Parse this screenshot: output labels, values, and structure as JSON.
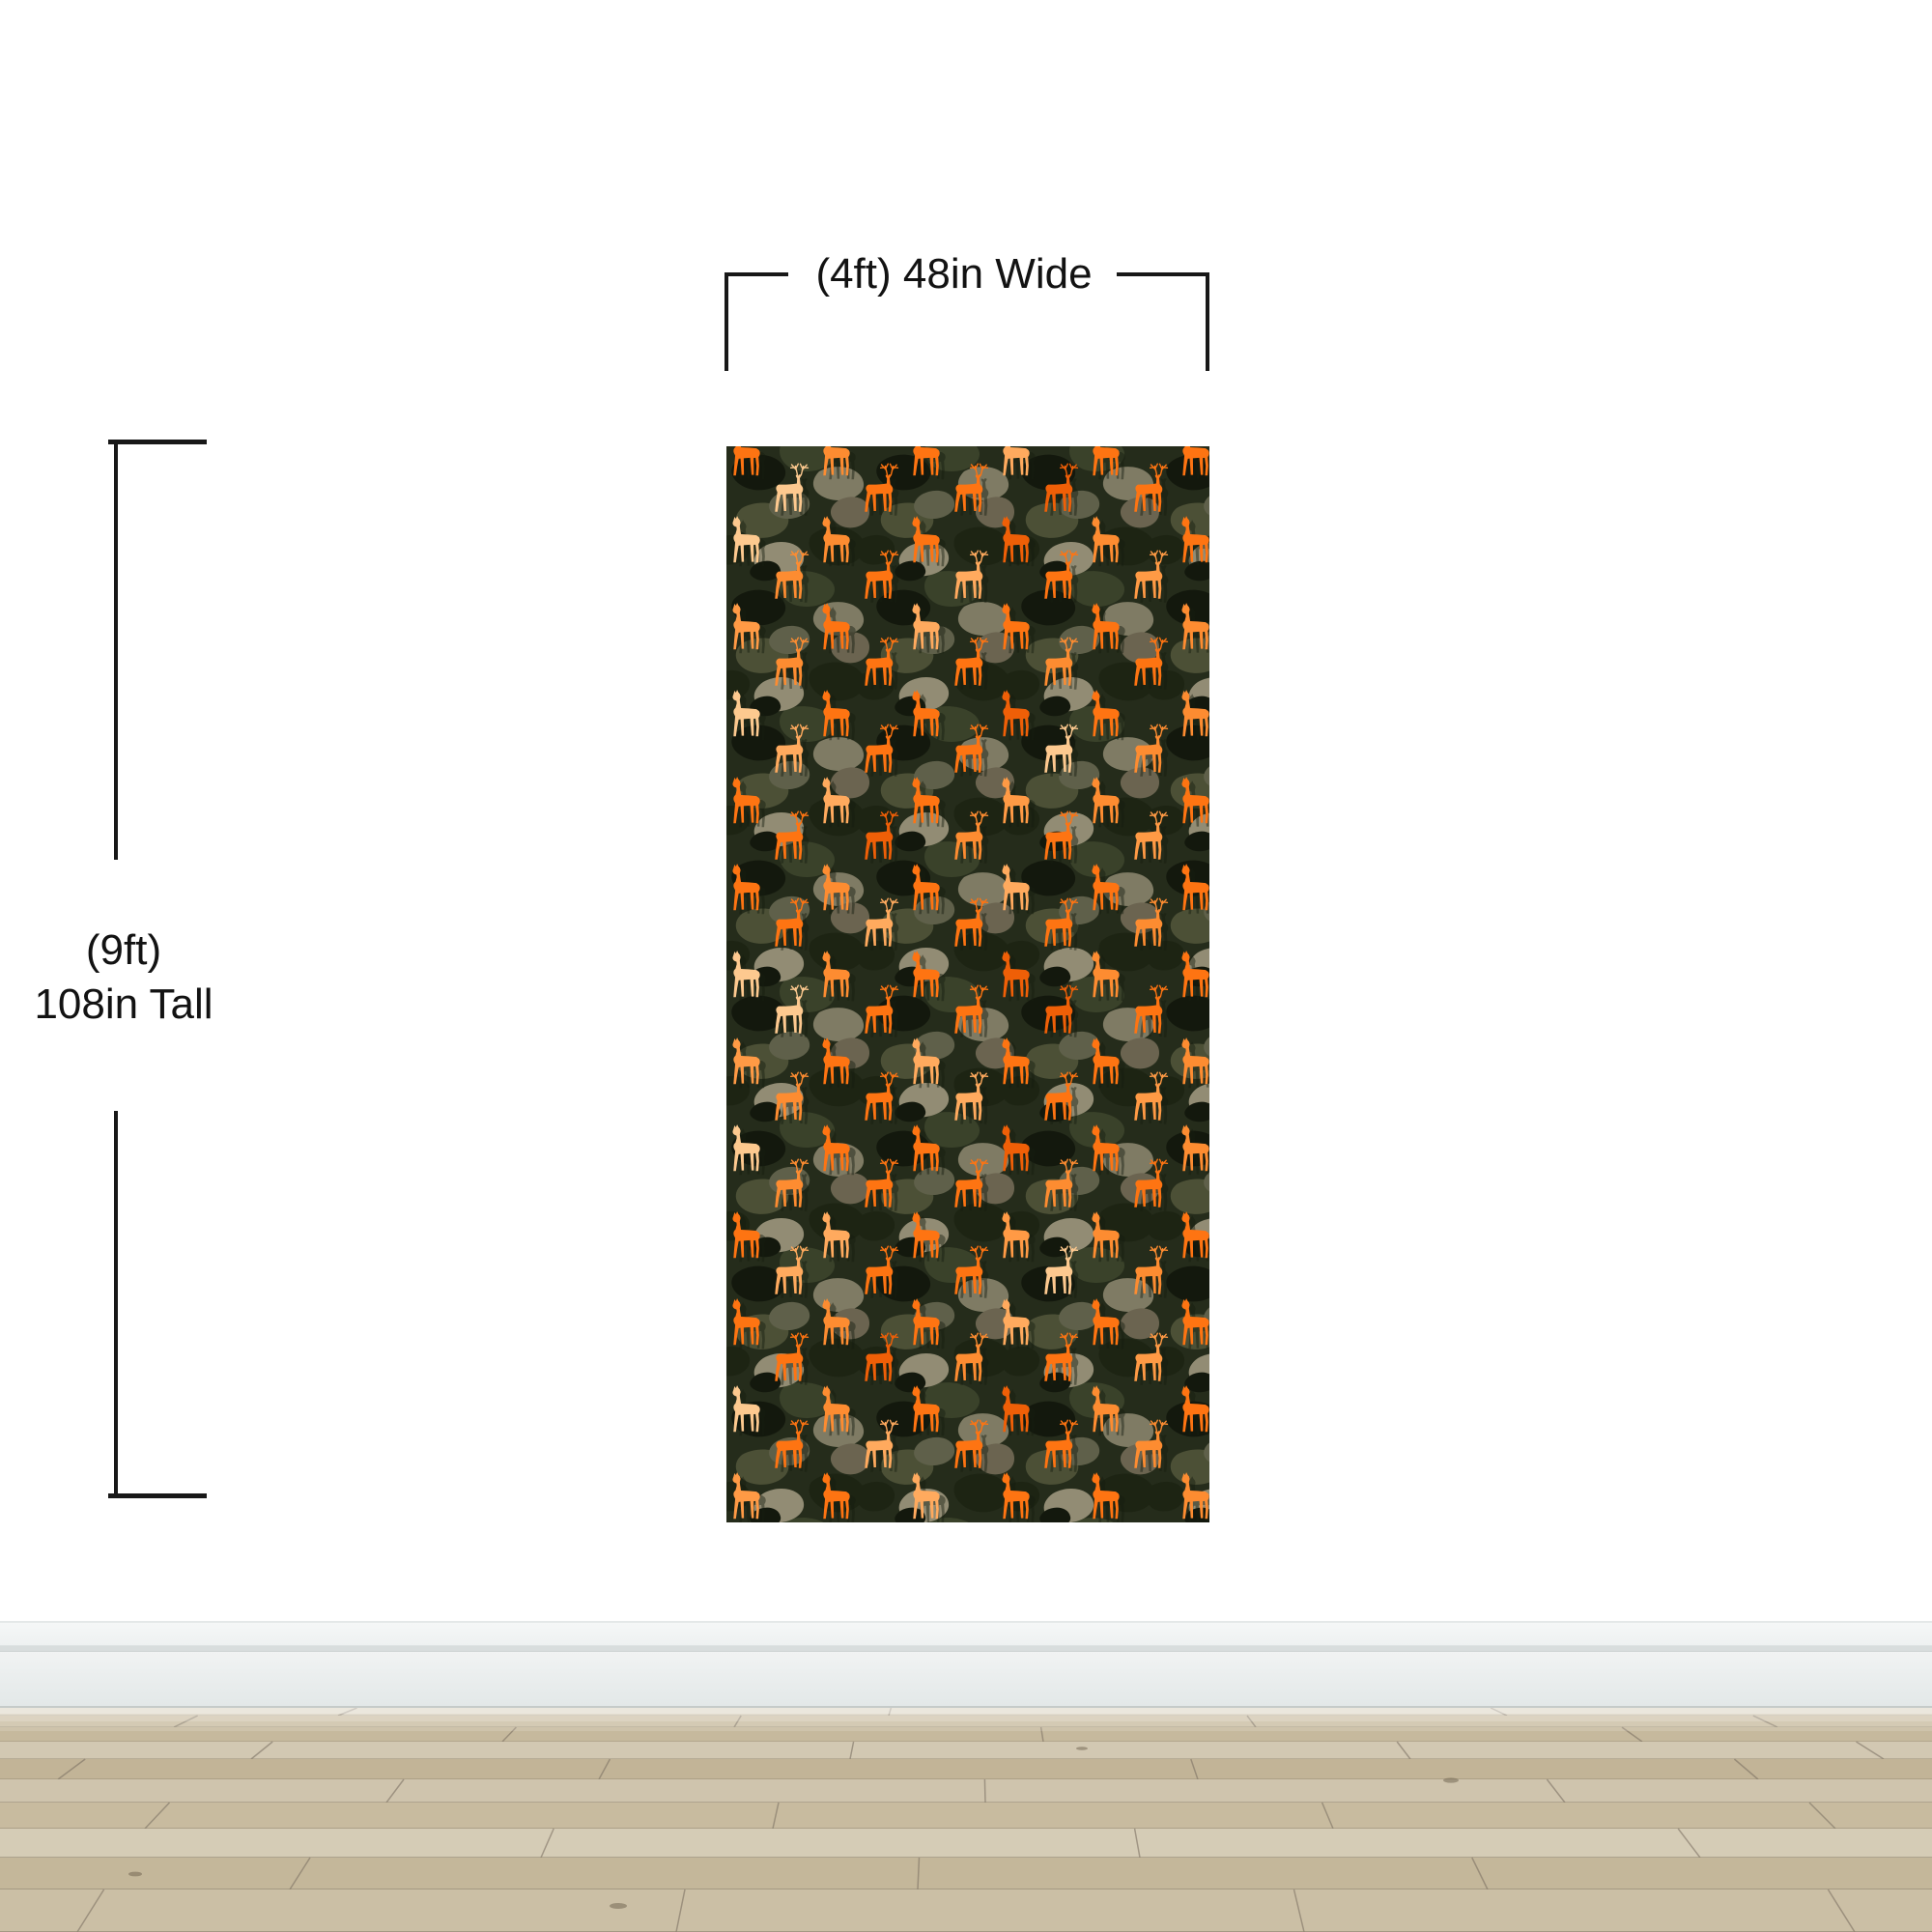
{
  "dimensions": {
    "width_label": "(4ft) 48in Wide",
    "height_label_line1": "(9ft)",
    "height_label_line2": "108in Tall",
    "line_color": "#181818",
    "text_color": "#121212"
  },
  "panel": {
    "camo_base": "#252c1b",
    "camo_colors": [
      "#13180d",
      "#1d2413",
      "#3a422a",
      "#4c5036",
      "#5f604a",
      "#6b6450",
      "#7f7b64",
      "#928c74"
    ],
    "deer_colors": [
      "#fe7412",
      "#fd8c31",
      "#ffaa5e",
      "#fdc98f",
      "#ef5f07",
      "#ff9a45"
    ],
    "deer_shadow_color": "#161d10"
  },
  "scene": {
    "wall_color": "#ffffff",
    "baseboard_color": "#eef1f1",
    "floor_plank_colors": [
      "#d7cebb",
      "#cdc1a7",
      "#c6b99d",
      "#d2c8b2",
      "#c2b497",
      "#cfc4ad",
      "#c8bb9f",
      "#d5ccb6",
      "#c4b79a",
      "#cbbfa5"
    ],
    "floor_seam_color": "#8e8470",
    "floor_vertical_seam_color": "#7d7264",
    "floor_knot_color": "#6b5f4c"
  }
}
